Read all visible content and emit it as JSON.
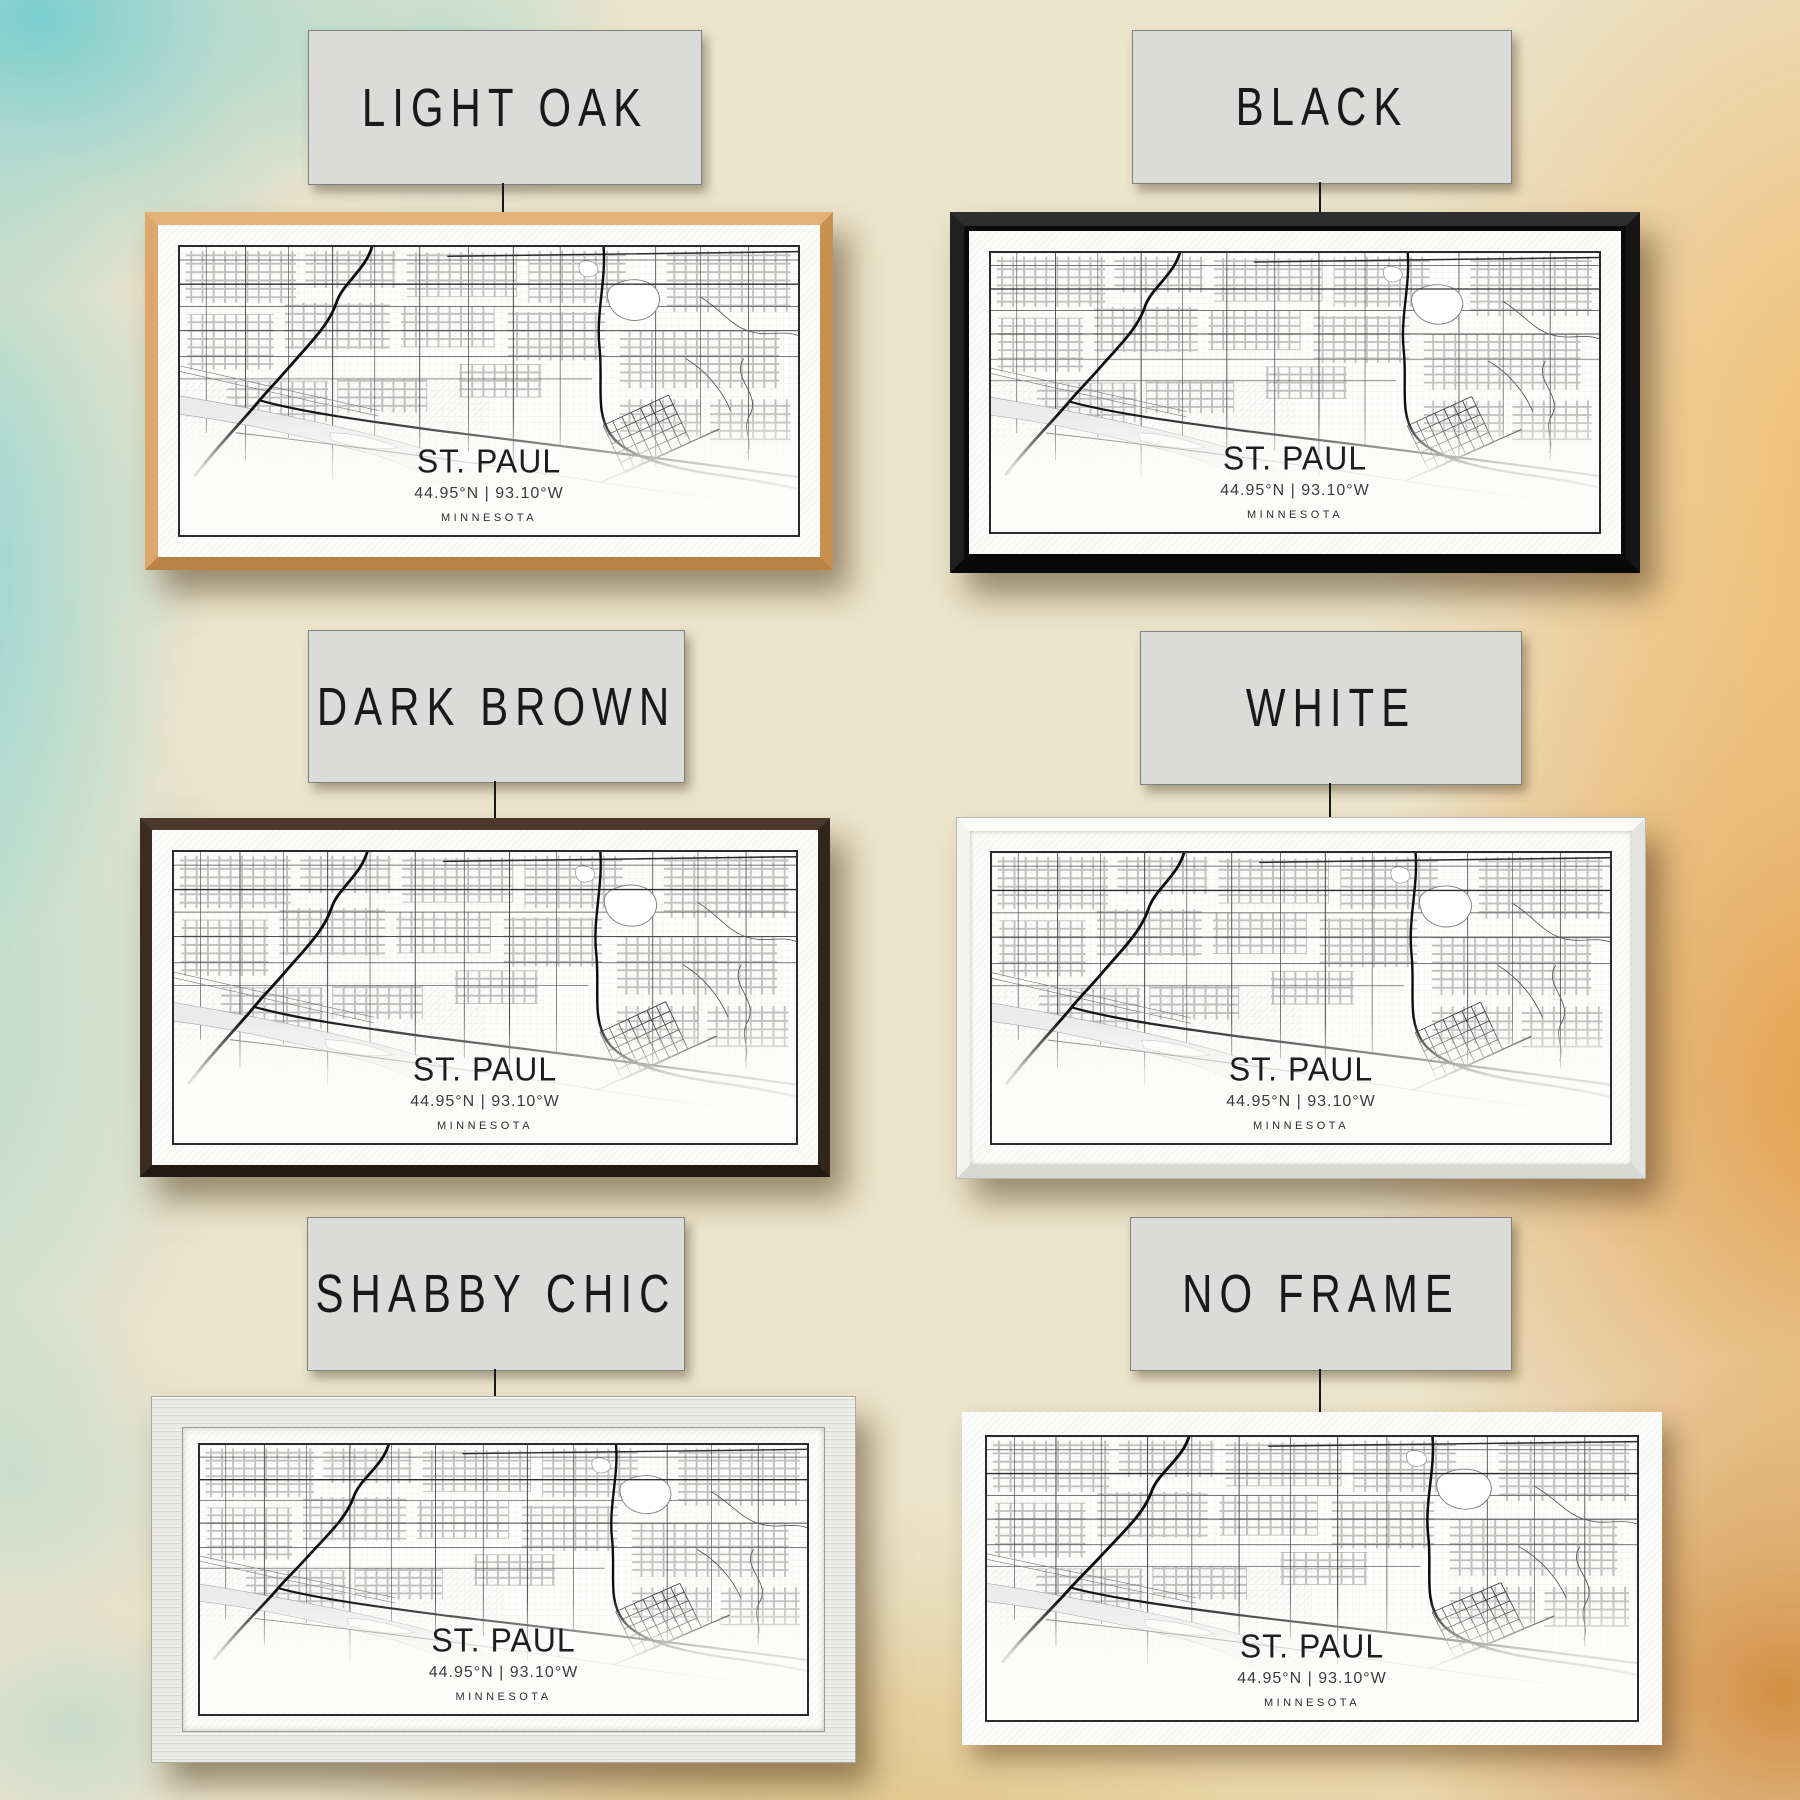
{
  "print": {
    "city": "ST. PAUL",
    "coordinates": "44.95°N | 93.10°W",
    "state": "MINNESOTA"
  },
  "options": [
    {
      "id": "light-oak",
      "label": "LIGHT OAK"
    },
    {
      "id": "black",
      "label": "BLACK"
    },
    {
      "id": "dark-brown",
      "label": "DARK BROWN"
    },
    {
      "id": "white",
      "label": "WHITE"
    },
    {
      "id": "shabby-chic",
      "label": "SHABBY CHIC"
    },
    {
      "id": "no-frame",
      "label": "NO FRAME"
    }
  ],
  "colors": {
    "label_background": "#dbdbda",
    "label_border": "#81817b",
    "label_text": "#191919",
    "frame_light_oak": "#d8a265",
    "frame_black": "#161616",
    "frame_dark_brown": "#32251c",
    "frame_white": "#f3f3f1",
    "frame_shabby_chic": "#e9e9e6",
    "paper": "#fcfcfa",
    "map_border": "#2b2b2b",
    "wall_teal": "#68cbd1",
    "wall_cream": "#ece4cb",
    "wall_orange": "#e29d3f"
  }
}
